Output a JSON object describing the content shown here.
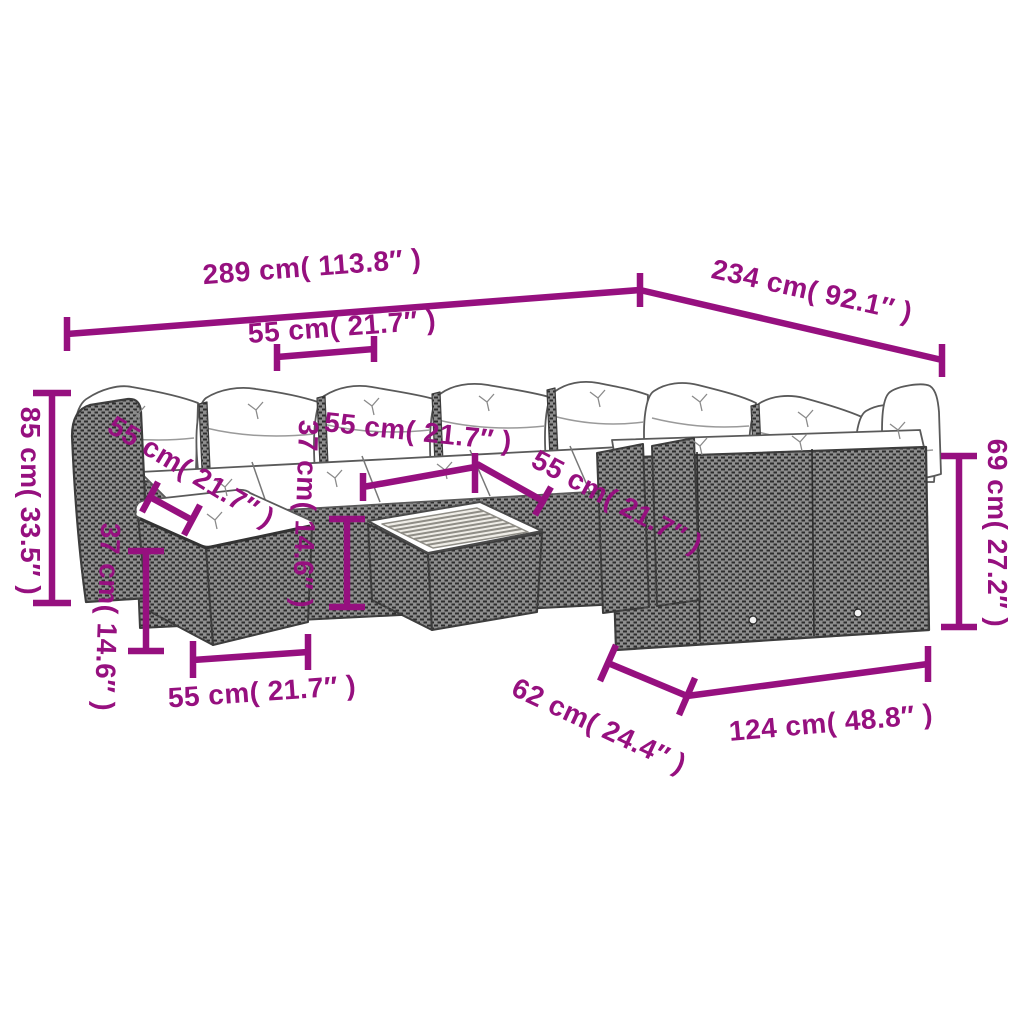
{
  "diagram": {
    "accent_color": "#96107F",
    "background_color": "#ffffff",
    "parts": [
      "corner-rattan-sofa",
      "back-cushions",
      "seat-cushions",
      "footstool",
      "slatted-coffee-table"
    ]
  },
  "dimensions": [
    {
      "id": "overall-width",
      "label": "289 cm( 113.8″ )"
    },
    {
      "id": "overall-depth",
      "label": "234 cm( 92.1″ )"
    },
    {
      "id": "seat-width-top",
      "label": "55 cm( 21.7″ )"
    },
    {
      "id": "back-height",
      "label": "85 cm( 33.5″ )"
    },
    {
      "id": "left-seat-depth",
      "label": "55 cm( 21.7″ )"
    },
    {
      "id": "footstool-height",
      "label": "37 cm( 14.6″ )"
    },
    {
      "id": "middle-seat-width",
      "label": "55 cm( 21.7″ )"
    },
    {
      "id": "seat-height",
      "label": "37 cm( 14.6″ )"
    },
    {
      "id": "corner-seat-width",
      "label": "55 cm( 21.7″ )"
    },
    {
      "id": "right-back-height",
      "label": "69 cm( 27.2″ )"
    },
    {
      "id": "footstool-width",
      "label": "55 cm( 21.7″ )"
    },
    {
      "id": "table-depth",
      "label": "62 cm( 24.4″ )"
    },
    {
      "id": "right-section-length",
      "label": "124 cm( 48.8″ )"
    }
  ]
}
